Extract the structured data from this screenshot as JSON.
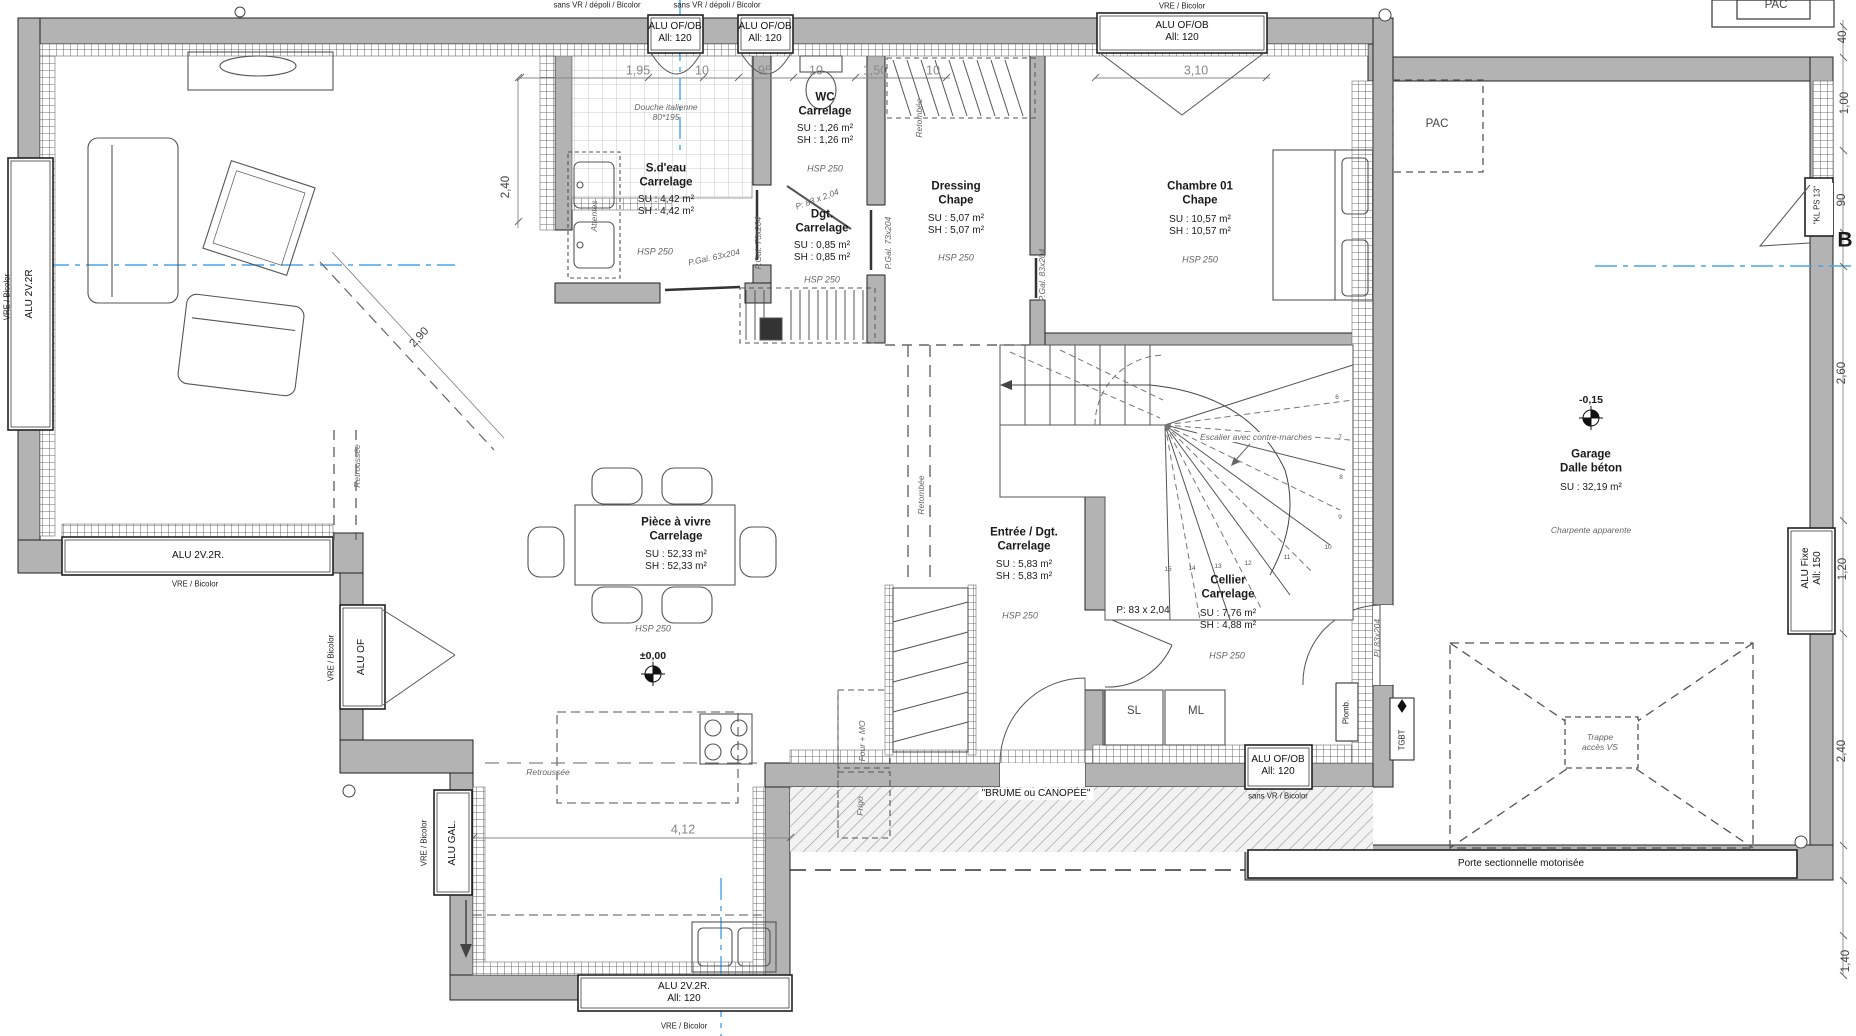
{
  "drawing": {
    "type": "architectural-floor-plan",
    "level_markers": [
      "±0,00",
      "-0,15"
    ],
    "section_marker": "B"
  },
  "colors": {
    "wall": "#b3b3b3",
    "axis_blue": "#4aa3e8",
    "dim_gray": "#888888",
    "line": "#1a1a1a"
  },
  "labels": [
    {
      "n": "note-sans-vr-1",
      "t": "sans VR / dépoli / Bicolor",
      "x": 597,
      "y": 5,
      "c": "tiny"
    },
    {
      "n": "note-sans-vr-2",
      "t": "sans VR / dépoli / Bicolor",
      "x": 717,
      "y": 5,
      "c": "tiny"
    },
    {
      "n": "window-label-top-1",
      "t": "ALU OF/OB\nAll: 120",
      "x": 675,
      "y": 33,
      "c": "win"
    },
    {
      "n": "window-label-top-2",
      "t": "ALU OF/OB\nAll: 120",
      "x": 765,
      "y": 33,
      "c": "win"
    },
    {
      "n": "note-vre-top",
      "t": "VRE / Bicolor",
      "x": 1182,
      "y": 6,
      "c": "tiny"
    },
    {
      "n": "window-label-top-3",
      "t": "ALU OF/OB\nAll: 120",
      "x": 1182,
      "y": 32,
      "c": "win"
    },
    {
      "n": "dim-195",
      "t": "1,95",
      "x": 638,
      "y": 71,
      "c": "dimd"
    },
    {
      "n": "dim-10a",
      "t": "10",
      "x": 702,
      "y": 71,
      "c": "dimd"
    },
    {
      "n": "dim-95",
      "t": "95",
      "x": 765,
      "y": 71,
      "c": "dimd"
    },
    {
      "n": "dim-10b",
      "t": "10",
      "x": 816,
      "y": 71,
      "c": "dimd"
    },
    {
      "n": "dim-150",
      "t": "1,50",
      "x": 875,
      "y": 71,
      "c": "dimd"
    },
    {
      "n": "dim-10c",
      "t": "10",
      "x": 933,
      "y": 71,
      "c": "dimd"
    },
    {
      "n": "dim-310",
      "t": "3,10",
      "x": 1196,
      "y": 71,
      "c": "dimd"
    },
    {
      "n": "room-sdeau-name",
      "t": "S.d'eau\nCarrelage",
      "x": 666,
      "y": 176,
      "c": "room"
    },
    {
      "n": "room-sdeau-areas",
      "t": "SU : 4,42 m²\nSH : 4,42 m²",
      "x": 666,
      "y": 206,
      "c": "val"
    },
    {
      "n": "room-sdeau-hsp",
      "t": "HSP 250",
      "x": 655,
      "y": 252,
      "c": "hsp"
    },
    {
      "n": "note-douche",
      "t": "Douche italienne\n80*195",
      "x": 666,
      "y": 112,
      "c": "ann"
    },
    {
      "n": "note-attentes",
      "t": "Attentes",
      "x": 594,
      "y": 216,
      "c": "ann",
      "r": -90
    },
    {
      "n": "room-wc-name",
      "t": "WC\nCarrelage",
      "x": 825,
      "y": 105,
      "c": "room"
    },
    {
      "n": "room-wc-areas",
      "t": "SU : 1,26 m²\nSH : 1,26 m²",
      "x": 825,
      "y": 135,
      "c": "val"
    },
    {
      "n": "room-wc-hsp",
      "t": "HSP 250",
      "x": 825,
      "y": 169,
      "c": "hsp"
    },
    {
      "n": "door-wc-size",
      "t": "P: 83 x 2,04",
      "x": 817,
      "y": 199,
      "c": "ann",
      "r": -20
    },
    {
      "n": "room-dgt-name",
      "t": "Dgt.\nCarrelage",
      "x": 822,
      "y": 222,
      "c": "room"
    },
    {
      "n": "room-dgt-areas",
      "t": "SU : 0,85 m²\nSH : 0,85 m²",
      "x": 822,
      "y": 252,
      "c": "val"
    },
    {
      "n": "room-dgt-hsp",
      "t": "HSP 250",
      "x": 822,
      "y": 280,
      "c": "hsp"
    },
    {
      "n": "door-pgal73-1",
      "t": "P.Gal. 73x204",
      "x": 758,
      "y": 243,
      "c": "ann",
      "r": -90
    },
    {
      "n": "door-pgal73-2",
      "t": "P.Gal. 73x204",
      "x": 888,
      "y": 243,
      "c": "ann",
      "r": -90
    },
    {
      "n": "door-pgal63",
      "t": "P.Gal. 63x204",
      "x": 714,
      "y": 257,
      "c": "ann",
      "r": -12
    },
    {
      "n": "room-dressing-name",
      "t": "Dressing\nChape",
      "x": 956,
      "y": 194,
      "c": "room"
    },
    {
      "n": "room-dressing-areas",
      "t": "SU : 5,07 m²\nSH : 5,07 m²",
      "x": 956,
      "y": 225,
      "c": "val"
    },
    {
      "n": "room-dressing-hsp",
      "t": "HSP 250",
      "x": 956,
      "y": 258,
      "c": "hsp"
    },
    {
      "n": "note-retombee-1",
      "t": "Retombée",
      "x": 919,
      "y": 118,
      "c": "ann",
      "r": -90
    },
    {
      "n": "door-pgal83",
      "t": "P.Gal. 83x204",
      "x": 1042,
      "y": 275,
      "c": "ann",
      "r": -90
    },
    {
      "n": "room-chambre-name",
      "t": "Chambre 01\nChape",
      "x": 1200,
      "y": 194,
      "c": "room"
    },
    {
      "n": "room-chambre-areas",
      "t": "SU : 10,57 m²\nSH : 10,57 m²",
      "x": 1200,
      "y": 226,
      "c": "val"
    },
    {
      "n": "room-chambre-hsp",
      "t": "HSP 250",
      "x": 1200,
      "y": 260,
      "c": "hsp"
    },
    {
      "n": "note-pac-inside",
      "t": "PAC",
      "x": 1437,
      "y": 125,
      "c": "dim"
    },
    {
      "n": "note-pac-outside",
      "t": "PAC",
      "x": 1776,
      "y": 6,
      "c": "dim"
    },
    {
      "n": "window-label-left",
      "t": "ALU 2V.2R",
      "x": 30,
      "y": 294,
      "c": "win",
      "r": -90
    },
    {
      "n": "note-vre-left",
      "t": "VRE / Bicolor",
      "x": 7,
      "y": 297,
      "c": "tiny",
      "r": -90
    },
    {
      "n": "dim-240-sdeau",
      "t": "2,40",
      "x": 507,
      "y": 187,
      "c": "dim",
      "r": -90
    },
    {
      "n": "dim-290",
      "t": "2,90",
      "x": 420,
      "y": 338,
      "c": "dim",
      "r": -47
    },
    {
      "n": "room-piece-name",
      "t": "Pièce à vivre\nCarrelage",
      "x": 676,
      "y": 530,
      "c": "room"
    },
    {
      "n": "room-piece-areas",
      "t": "SU : 52,33 m²\nSH : 52,33 m²",
      "x": 676,
      "y": 561,
      "c": "val"
    },
    {
      "n": "room-piece-hsp",
      "t": "HSP 250",
      "x": 653,
      "y": 629,
      "c": "hsp"
    },
    {
      "n": "level-zero",
      "t": "±0,00",
      "x": 653,
      "y": 656,
      "c": "lvl"
    },
    {
      "n": "note-retroussee-v",
      "t": "Retroussée",
      "x": 357,
      "y": 466,
      "c": "ann",
      "r": -90
    },
    {
      "n": "window-label-lb",
      "t": "ALU 2V.2R.",
      "x": 198,
      "y": 556,
      "c": "win"
    },
    {
      "n": "note-vre-lb",
      "t": "VRE / Bicolor",
      "x": 195,
      "y": 584,
      "c": "tiny"
    },
    {
      "n": "window-label-aluof",
      "t": "ALU OF",
      "x": 362,
      "y": 657,
      "c": "win",
      "r": -90
    },
    {
      "n": "note-vre-aluof",
      "t": "VRE / Bicolor",
      "x": 331,
      "y": 658,
      "c": "tiny",
      "r": -90
    },
    {
      "n": "window-label-alugal",
      "t": "ALU GAL.",
      "x": 453,
      "y": 843,
      "c": "win",
      "r": -90
    },
    {
      "n": "note-vre-alugal",
      "t": "VRE / Bicolor",
      "x": 424,
      "y": 843,
      "c": "tiny",
      "r": -90
    },
    {
      "n": "note-retroussee-h",
      "t": "Retroussée",
      "x": 548,
      "y": 772,
      "c": "ann"
    },
    {
      "n": "dim-412",
      "t": "4,12",
      "x": 683,
      "y": 830,
      "c": "dimd"
    },
    {
      "n": "note-four-mo",
      "t": "Four + MO",
      "x": 862,
      "y": 741,
      "c": "ann",
      "r": -90
    },
    {
      "n": "note-frigo",
      "t": "Frigo",
      "x": 860,
      "y": 806,
      "c": "ann",
      "r": -90
    },
    {
      "n": "window-label-kitchen",
      "t": "ALU 2V.2R.\nAll: 120",
      "x": 684,
      "y": 993,
      "c": "win"
    },
    {
      "n": "note-vre-kitchen",
      "t": "VRE / Bicolor",
      "x": 684,
      "y": 1026,
      "c": "tiny"
    },
    {
      "n": "room-entree-name",
      "t": "Entrée / Dgt.\nCarrelage",
      "x": 1024,
      "y": 540,
      "c": "room"
    },
    {
      "n": "room-entree-areas",
      "t": "SU : 5,83 m²\nSH : 5,83 m²",
      "x": 1024,
      "y": 571,
      "c": "val"
    },
    {
      "n": "room-entree-hsp",
      "t": "HSP 250",
      "x": 1020,
      "y": 616,
      "c": "hsp"
    },
    {
      "n": "note-retombee-2",
      "t": "Retombée",
      "x": 921,
      "y": 495,
      "c": "ann",
      "r": -90
    },
    {
      "n": "door-cellier-size",
      "t": "P: 83 x 2,04",
      "x": 1143,
      "y": 611,
      "c": "val"
    },
    {
      "n": "room-cellier-name",
      "t": "Cellier\nCarrelage",
      "x": 1228,
      "y": 588,
      "c": "room"
    },
    {
      "n": "room-cellier-areas",
      "t": "SU : 7,76 m²\nSH : 4,88 m²",
      "x": 1228,
      "y": 620,
      "c": "val"
    },
    {
      "n": "room-cellier-hsp",
      "t": "HSP 250",
      "x": 1227,
      "y": 656,
      "c": "hsp"
    },
    {
      "n": "door-pi83",
      "t": "PI 83x204",
      "x": 1377,
      "y": 638,
      "c": "ann",
      "r": -90
    },
    {
      "n": "appliance-sl",
      "t": "SL",
      "x": 1134,
      "y": 712,
      "c": "dim"
    },
    {
      "n": "appliance-ml",
      "t": "ML",
      "x": 1196,
      "y": 712,
      "c": "dim"
    },
    {
      "n": "note-plomb",
      "t": "Plomb.",
      "x": 1346,
      "y": 712,
      "c": "tiny",
      "r": -90
    },
    {
      "n": "note-tgbt",
      "t": "TGBT",
      "x": 1402,
      "y": 740,
      "c": "tiny",
      "r": -90
    },
    {
      "n": "window-label-cellier",
      "t": "ALU OF/OB\nAll: 120",
      "x": 1278,
      "y": 766,
      "c": "win"
    },
    {
      "n": "note-sans-vr-cellier",
      "t": "sans VR / Bicolor",
      "x": 1278,
      "y": 796,
      "c": "tiny"
    },
    {
      "n": "note-brume",
      "t": "\"BRUME ou CANOPÉE\"",
      "x": 1036,
      "y": 794,
      "c": "win bg"
    },
    {
      "n": "note-escalier",
      "t": "Escalier avec contre-marches",
      "x": 1256,
      "y": 437,
      "c": "ann bg"
    },
    {
      "n": "step-6",
      "t": "6",
      "x": 1337,
      "y": 398,
      "c": "steps"
    },
    {
      "n": "step-7",
      "t": "7",
      "x": 1340,
      "y": 438,
      "c": "steps"
    },
    {
      "n": "step-8",
      "t": "8",
      "x": 1341,
      "y": 478,
      "c": "steps"
    },
    {
      "n": "step-9",
      "t": "9",
      "x": 1340,
      "y": 518,
      "c": "steps"
    },
    {
      "n": "step-10",
      "t": "10",
      "x": 1328,
      "y": 548,
      "c": "steps"
    },
    {
      "n": "step-11",
      "t": "11",
      "x": 1287,
      "y": 558,
      "c": "steps"
    },
    {
      "n": "step-12",
      "t": "12",
      "x": 1248,
      "y": 564,
      "c": "steps"
    },
    {
      "n": "step-13",
      "t": "13",
      "x": 1218,
      "y": 567,
      "c": "steps"
    },
    {
      "n": "step-14",
      "t": "14",
      "x": 1192,
      "y": 569,
      "c": "steps"
    },
    {
      "n": "step-15",
      "t": "15",
      "x": 1168,
      "y": 570,
      "c": "steps"
    },
    {
      "n": "level-minus15",
      "t": "-0,15",
      "x": 1591,
      "y": 400,
      "c": "lvl"
    },
    {
      "n": "room-garage-name",
      "t": "Garage\nDalle béton",
      "x": 1591,
      "y": 462,
      "c": "room"
    },
    {
      "n": "room-garage-areas",
      "t": "SU : 32,19 m²",
      "x": 1591,
      "y": 488,
      "c": "val"
    },
    {
      "n": "note-charpente",
      "t": "Charpente apparente",
      "x": 1591,
      "y": 530,
      "c": "ann"
    },
    {
      "n": "note-trappe",
      "t": "Trappe\naccès VS",
      "x": 1600,
      "y": 742,
      "c": "ann bg"
    },
    {
      "n": "door-garage-label",
      "t": "Porte sectionnelle motorisée",
      "x": 1521,
      "y": 864,
      "c": "win"
    },
    {
      "n": "dim-40",
      "t": "40",
      "x": 1844,
      "y": 37,
      "c": "dim",
      "r": -90
    },
    {
      "n": "dim-100",
      "t": "1,00",
      "x": 1846,
      "y": 103,
      "c": "dim",
      "r": -90
    },
    {
      "n": "door-klps",
      "t": "\"KL PS 13\"",
      "x": 1817,
      "y": 205,
      "c": "tiny",
      "r": -90
    },
    {
      "n": "dim-90",
      "t": "90",
      "x": 1843,
      "y": 200,
      "c": "dim",
      "r": -90
    },
    {
      "n": "section-b",
      "t": "B",
      "x": 1845,
      "y": 241,
      "c": "b"
    },
    {
      "n": "dim-260",
      "t": "2,60",
      "x": 1843,
      "y": 373,
      "c": "dim",
      "r": -90
    },
    {
      "n": "window-label-alufixe",
      "t": "ALU Fixe\nAll: 150",
      "x": 1812,
      "y": 568,
      "c": "win",
      "r": -90
    },
    {
      "n": "dim-120",
      "t": "1,20",
      "x": 1844,
      "y": 569,
      "c": "dim",
      "r": -90
    },
    {
      "n": "dim-240-garage",
      "t": "2,40",
      "x": 1843,
      "y": 751,
      "c": "dim",
      "r": -90
    },
    {
      "n": "dim-140",
      "t": "1,40",
      "x": 1847,
      "y": 961,
      "c": "dim",
      "r": -90
    }
  ]
}
